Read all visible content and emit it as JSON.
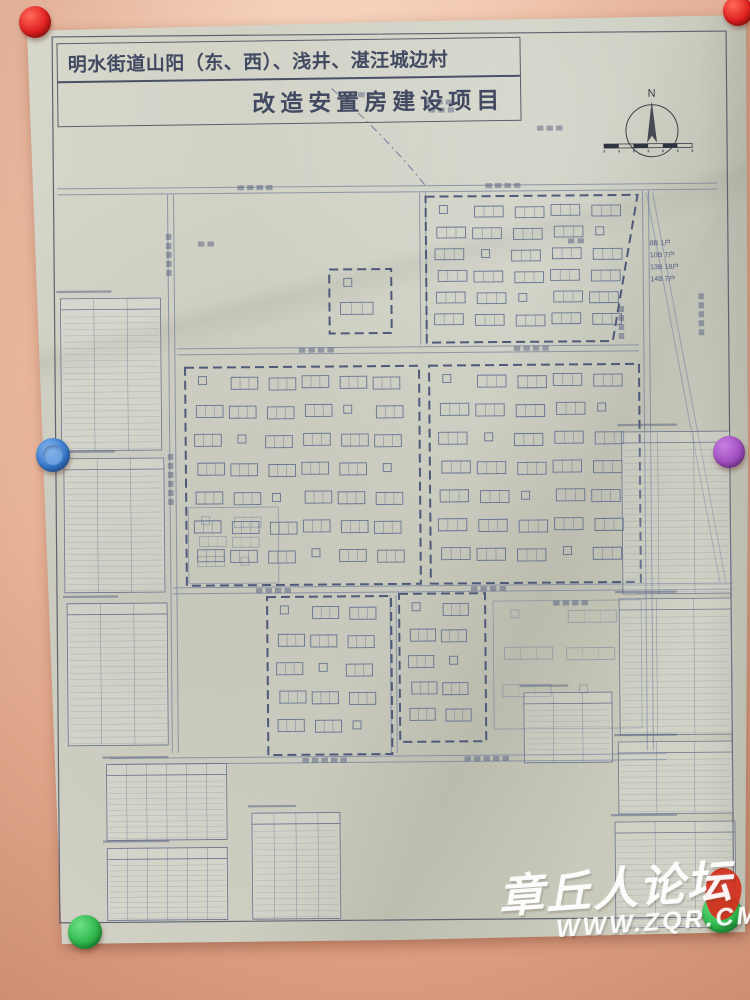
{
  "scene": {
    "wall_color": "#eab69b",
    "paper_color": "#cdcec1"
  },
  "title": {
    "line1": "明水街道山阳（东、西）、浅井、湛汪城边村",
    "line2": "改造安置房建设项目"
  },
  "compass": {
    "label": "N"
  },
  "annotations": {
    "unit_counts": [
      "8B 1户",
      "10B 7户",
      "13B 18户",
      "14B 7户"
    ]
  },
  "watermark": {
    "site_name": "章丘人论坛",
    "site_url": "WWW.ZQR.CM",
    "seal_color": "#d33120"
  },
  "magnets": [
    {
      "id": "magnet-red-top-left",
      "color": "#e02020",
      "hi": "#ff6a5a",
      "lo": "#8f0f0c",
      "x": 35,
      "y": 22,
      "r": 16
    },
    {
      "id": "magnet-red-top-right",
      "color": "#e02020",
      "hi": "#ff6a5a",
      "lo": "#8f0f0c",
      "x": 738,
      "y": 11,
      "r": 15
    },
    {
      "id": "magnet-blue-left",
      "color": "#3a7bd0",
      "hi": "#7fb1e8",
      "lo": "#1d4f93",
      "x": 53,
      "y": 455,
      "r": 17,
      "ring": true
    },
    {
      "id": "magnet-purple-right",
      "color": "#a14fc0",
      "hi": "#c77fe0",
      "lo": "#6e2f8a",
      "x": 729,
      "y": 452,
      "r": 16
    },
    {
      "id": "magnet-green-bottom-left",
      "color": "#2eb84a",
      "hi": "#6fe08a",
      "lo": "#157a2c",
      "x": 85,
      "y": 932,
      "r": 17
    },
    {
      "id": "magnet-green-bottom-right",
      "color": "#2eb84a",
      "hi": "#6fe08a",
      "lo": "#157a2c",
      "x": 722,
      "y": 913,
      "r": 20
    }
  ],
  "plan": {
    "stroke": "#5c6a8e",
    "road_stroke": "#7b86a2",
    "frame_stroke": "#5d6370",
    "table_stroke": "#6a7390",
    "textbar_fill": "#55607f",
    "frame": {
      "x": 56,
      "y": 34,
      "w": 674,
      "h": 886
    },
    "roads_h": [
      [
        60,
        189,
        660
      ],
      [
        178,
        350,
        462
      ],
      [
        172,
        589,
        560
      ],
      [
        108,
        759,
        556
      ]
    ],
    "roads_v": [
      [
        173,
        193,
        558
      ],
      [
        425,
        193,
        152
      ],
      [
        648,
        193,
        560
      ],
      [
        392,
        595,
        158
      ]
    ],
    "roads_d": [
      [
        652,
        195,
        722,
        585
      ]
    ],
    "boundary_curve": "M335,88 C362,112 400,150 428,186",
    "blocks": [
      {
        "x": 428,
        "y": 197,
        "w": 212,
        "h": 146,
        "rows": 6,
        "cols": 5,
        "slant": 26
      },
      {
        "x": 331,
        "y": 269,
        "w": 62,
        "h": 64,
        "rows": 2,
        "cols": 1
      },
      {
        "x": 186,
        "y": 366,
        "w": 234,
        "h": 218,
        "rows": 7,
        "cols": 6
      },
      {
        "x": 430,
        "y": 366,
        "w": 210,
        "h": 218,
        "rows": 7,
        "cols": 5
      },
      {
        "x": 266,
        "y": 596,
        "w": 124,
        "h": 158,
        "rows": 5,
        "cols": 3
      },
      {
        "x": 398,
        "y": 594,
        "w": 86,
        "h": 148,
        "rows": 5,
        "cols": 2
      }
    ],
    "faint_blocks": [
      {
        "x": 188,
        "y": 506,
        "w": 90,
        "h": 76,
        "rows": 3,
        "cols": 2
      },
      {
        "x": 492,
        "y": 602,
        "w": 148,
        "h": 128,
        "rows": 3,
        "cols": 2
      }
    ],
    "tables": [
      {
        "x": 62,
        "y": 296,
        "w": 100,
        "h": 152,
        "rows": 22,
        "cols": 3
      },
      {
        "x": 64,
        "y": 456,
        "w": 100,
        "h": 134,
        "rows": 20,
        "cols": 3
      },
      {
        "x": 66,
        "y": 601,
        "w": 100,
        "h": 142,
        "rows": 20,
        "cols": 3
      },
      {
        "x": 104,
        "y": 762,
        "w": 120,
        "h": 76,
        "rows": 11,
        "cols": 6
      },
      {
        "x": 104,
        "y": 846,
        "w": 120,
        "h": 72,
        "rows": 11,
        "cols": 6
      },
      {
        "x": 249,
        "y": 812,
        "w": 88,
        "h": 106,
        "rows": 15,
        "cols": 4
      },
      {
        "x": 522,
        "y": 694,
        "w": 88,
        "h": 70,
        "rows": 10,
        "cols": 3
      },
      {
        "x": 612,
        "y": 824,
        "w": 120,
        "h": 106,
        "rows": 15,
        "cols": 3
      },
      {
        "x": 622,
        "y": 434,
        "w": 108,
        "h": 162,
        "rows": 23,
        "cols": 3
      },
      {
        "x": 618,
        "y": 601,
        "w": 112,
        "h": 136,
        "rows": 19,
        "cols": 3
      },
      {
        "x": 616,
        "y": 744,
        "w": 114,
        "h": 72,
        "rows": 10,
        "cols": 3
      }
    ],
    "textbars": [
      {
        "x": 240,
        "y": 184,
        "n": 4
      },
      {
        "x": 488,
        "y": 184,
        "n": 4
      },
      {
        "x": 300,
        "y": 347,
        "n": 4
      },
      {
        "x": 515,
        "y": 347,
        "n": 4
      },
      {
        "x": 255,
        "y": 587,
        "n": 4
      },
      {
        "x": 470,
        "y": 587,
        "n": 4
      },
      {
        "x": 300,
        "y": 757,
        "n": 5
      },
      {
        "x": 462,
        "y": 757,
        "n": 5
      },
      {
        "x": 430,
        "y": 100,
        "n": 3
      },
      {
        "x": 432,
        "y": 108,
        "n": 3
      },
      {
        "x": 540,
        "y": 127,
        "n": 3
      },
      {
        "x": 352,
        "y": 92,
        "n": 3
      },
      {
        "x": 200,
        "y": 240,
        "n": 2
      },
      {
        "x": 570,
        "y": 240,
        "n": 2
      },
      {
        "x": 552,
        "y": 602,
        "n": 4
      },
      {
        "x": 168,
        "y": 232,
        "n": 5,
        "v": true
      },
      {
        "x": 168,
        "y": 452,
        "n": 6,
        "v": true
      },
      {
        "x": 700,
        "y": 296,
        "n": 5,
        "v": true
      },
      {
        "x": 620,
        "y": 308,
        "n": 4,
        "v": true
      }
    ],
    "compass": {
      "cx": 655,
      "cy": 133,
      "r": 26
    },
    "scalebar": {
      "x": 607,
      "y": 146,
      "w": 88,
      "segs": 6
    }
  }
}
